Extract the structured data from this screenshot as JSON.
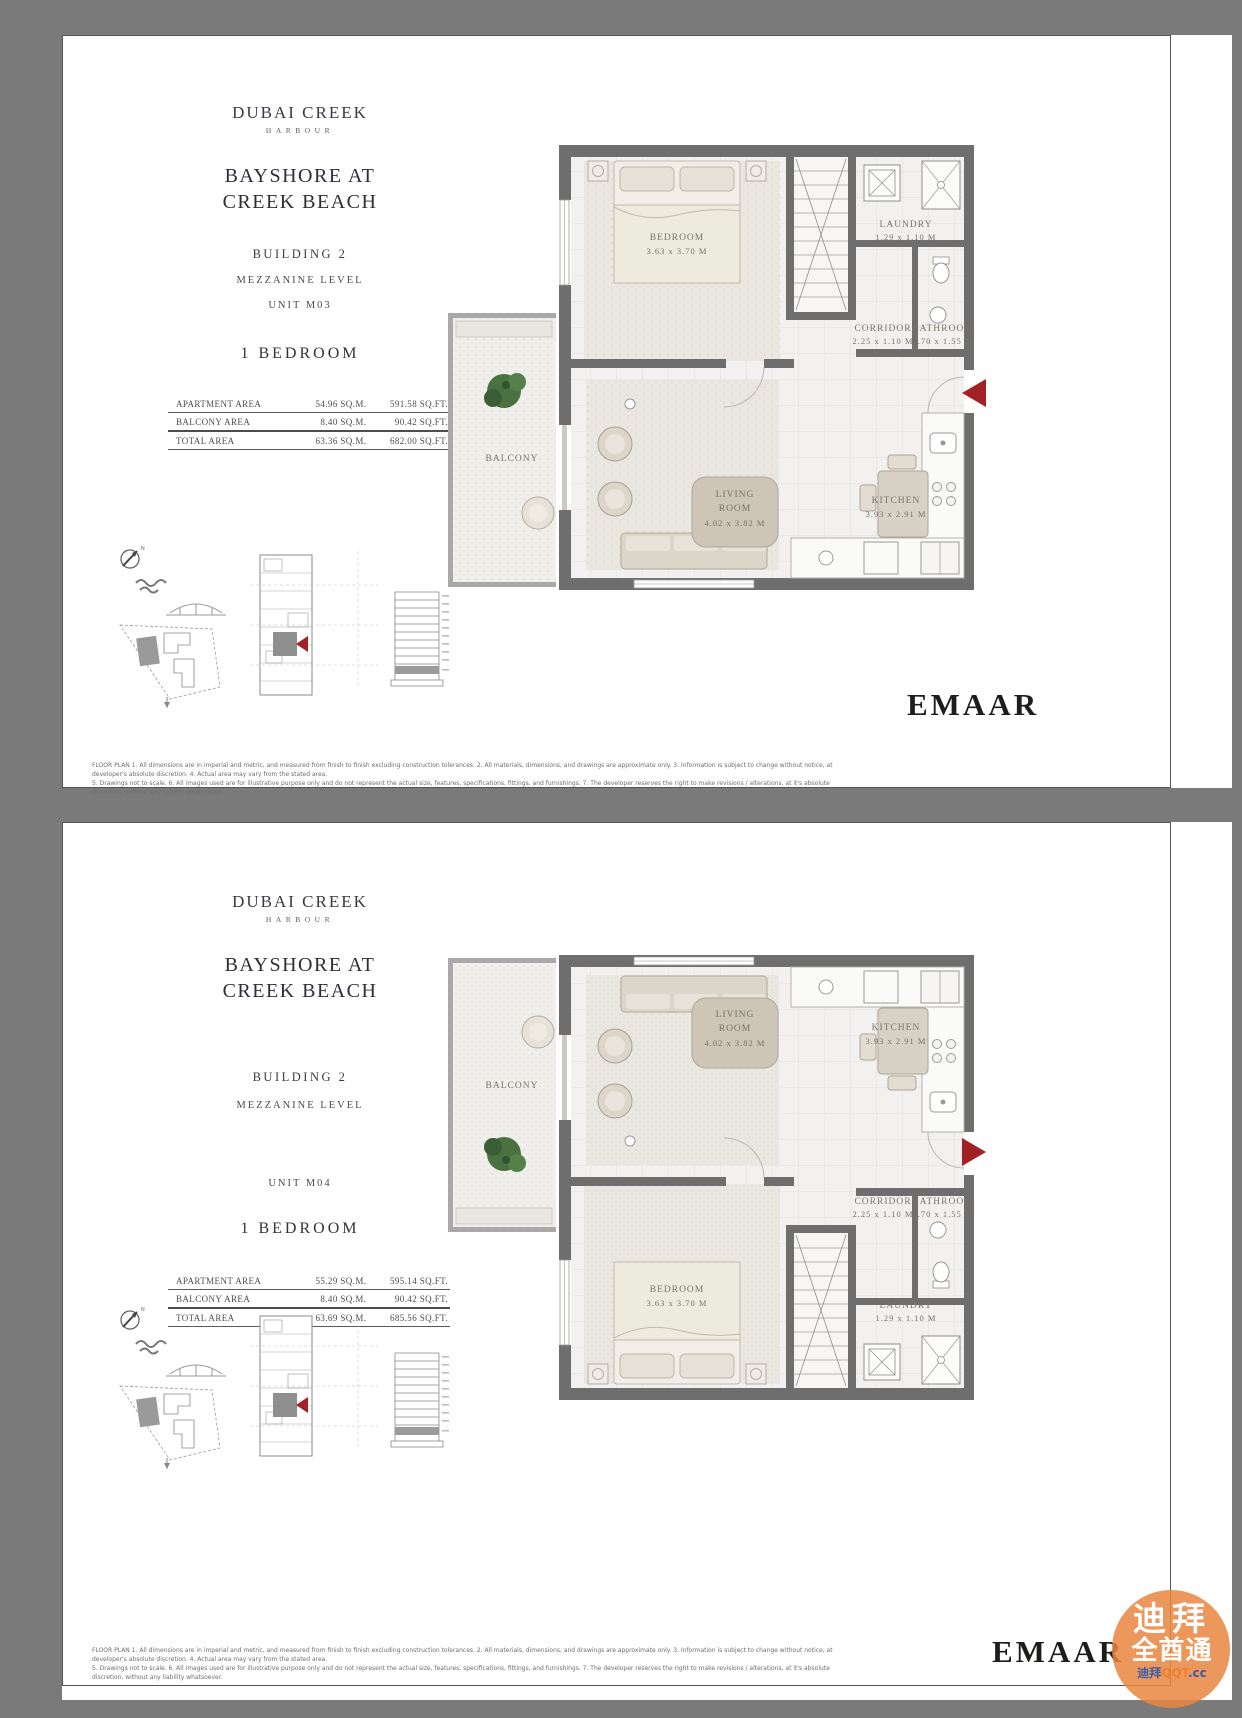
{
  "colors": {
    "accent_red": "#A32026",
    "wall_grey": "#6E6E6E",
    "watermark_orange": "#E98640",
    "brand_dark": "#1D1D1B"
  },
  "diagrams": {
    "compass_n": "N"
  },
  "watermark": {
    "line1": "迪拜",
    "line2": "全酋通",
    "line3_prefix": "迪拜",
    "line3_main": "QQT",
    "line3_suffix": ".cc"
  },
  "pages": [
    {
      "brand_line1": "DUBAI CREEK",
      "brand_line2": "HARBOUR",
      "title_line1": "BAYSHORE AT",
      "title_line2": "CREEK BEACH",
      "building": "BUILDING 2",
      "level": "MEZZANINE LEVEL",
      "unit": "UNIT M03",
      "bedrooms": "1 BEDROOM",
      "area_table": {
        "rows": [
          {
            "label": "APARTMENT AREA",
            "sqm": "54.96 SQ.M.",
            "sqft": "591.58 SQ.FT."
          },
          {
            "label": "BALCONY AREA",
            "sqm": "8.40 SQ.M.",
            "sqft": "90.42 SQ.FT."
          },
          {
            "label": "TOTAL AREA",
            "sqm": "63.36 SQ.M.",
            "sqft": "682.00 SQ.FT."
          }
        ]
      },
      "plan": {
        "bedroom_name": "BEDROOM",
        "bedroom_dims": "3.63 x 3.70 M",
        "laundry_name": "LAUNDRY",
        "laundry_dims": "1.29 x 1.10 M",
        "corridor_name": "CORRIDOR",
        "corridor_dims": "2.25 x 1.10 M",
        "bathroom_name": "BATHROOM",
        "bathroom_dims": "2.70 x 1.55 M",
        "balcony_name": "BALCONY",
        "living_name_line1": "LIVING",
        "living_name_line2": "ROOM",
        "living_dims": "4.02 x 3.82 M",
        "kitchen_name": "KITCHEN",
        "kitchen_dims": "3.93 x 2.91 M"
      },
      "disclaimer_line1": "FLOOR PLAN 1. All dimensions are in imperial and metric, and measured from finish to finish excluding construction tolerances. 2. All materials, dimensions, and drawings are approximate only. 3. Information is subject to change without notice, at developer's absolute discretion. 4. Actual area may vary from the stated area.",
      "disclaimer_line2": "5. Drawings not to scale. 6. All images used are for illustrative purpose only and do not represent the actual size, features, specifications, fittings, and furnishings. 7. The developer reserves the right to make revisions / alterations, at it's absolute discretion, without any liability whatsoever.",
      "brand_wordmark": "EMAAR"
    },
    {
      "brand_line1": "DUBAI CREEK",
      "brand_line2": "HARBOUR",
      "title_line1": "BAYSHORE AT",
      "title_line2": "CREEK BEACH",
      "building": "BUILDING 2",
      "level": "MEZZANINE LEVEL",
      "unit": "UNIT M04",
      "bedrooms": "1 BEDROOM",
      "area_table": {
        "rows": [
          {
            "label": "APARTMENT AREA",
            "sqm": "55.29 SQ.M.",
            "sqft": "595.14 SQ.FT."
          },
          {
            "label": "BALCONY AREA",
            "sqm": "8.40 SQ.M.",
            "sqft": "90.42 SQ.FT."
          },
          {
            "label": "TOTAL AREA",
            "sqm": "63.69 SQ.M.",
            "sqft": "685.56 SQ.FT."
          }
        ]
      },
      "plan": {
        "bedroom_name": "BEDROOM",
        "bedroom_dims": "3.63 x 3.70 M",
        "laundry_name": "LAUNDRY",
        "laundry_dims": "1.29 x 1.10 M",
        "corridor_name": "CORRIDOR",
        "corridor_dims": "2.25 x 1.10 M",
        "bathroom_name": "BATHROOM",
        "bathroom_dims": "2.70 x 1.55 M",
        "balcony_name": "BALCONY",
        "living_name_line1": "LIVING",
        "living_name_line2": "ROOM",
        "living_dims": "4.02 x 3.82 M",
        "kitchen_name": "KITCHEN",
        "kitchen_dims": "3.93 x 2.91 M"
      },
      "disclaimer_line1": "FLOOR PLAN 1. All dimensions are in imperial and metric, and measured from finish to finish excluding construction tolerances. 2. All materials, dimensions, and drawings are approximate only. 3. Information is subject to change without notice, at developer's absolute discretion. 4. Actual area may vary from the stated area.",
      "disclaimer_line2": "5. Drawings not to scale. 6. All images used are for illustrative purpose only and do not represent the actual size, features, specifications, fittings, and furnishings. 7. The developer reserves the right to make revisions / alterations, at it's absolute discretion, without any liability whatsoever.",
      "brand_wordmark": "EMAAR"
    }
  ]
}
